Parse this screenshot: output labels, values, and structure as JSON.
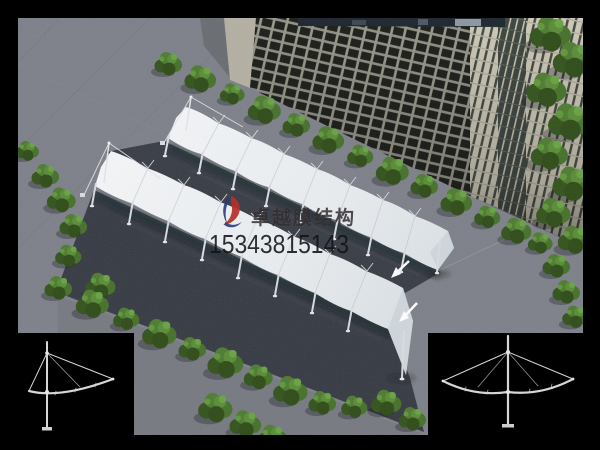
{
  "watermark": {
    "company_name": "卓越膜结构",
    "phone_number": "15343815143",
    "logo_red": "#b5302a",
    "logo_blue": "#2a3a7e"
  },
  "annotations": {
    "arrow_color": "#ffffff",
    "arrow_count": 2
  },
  "corner_diagrams": {
    "left_icon": "single-cantilever-support-drawing",
    "right_icon": "double-cantilever-support-drawing",
    "line_color": "#d6d6d6",
    "background": "#000000"
  },
  "palette": {
    "border_black": "#000000",
    "pavement_gray": "#7c7f88",
    "asphalt_dark": "#363a43",
    "membrane_white": "#eef1f4",
    "tree_green": "#45702a",
    "building_window": "#23261f",
    "building_mullion": "#97978b",
    "beige_tower": "#cec9b6",
    "glass_tower": "#3a423c"
  }
}
